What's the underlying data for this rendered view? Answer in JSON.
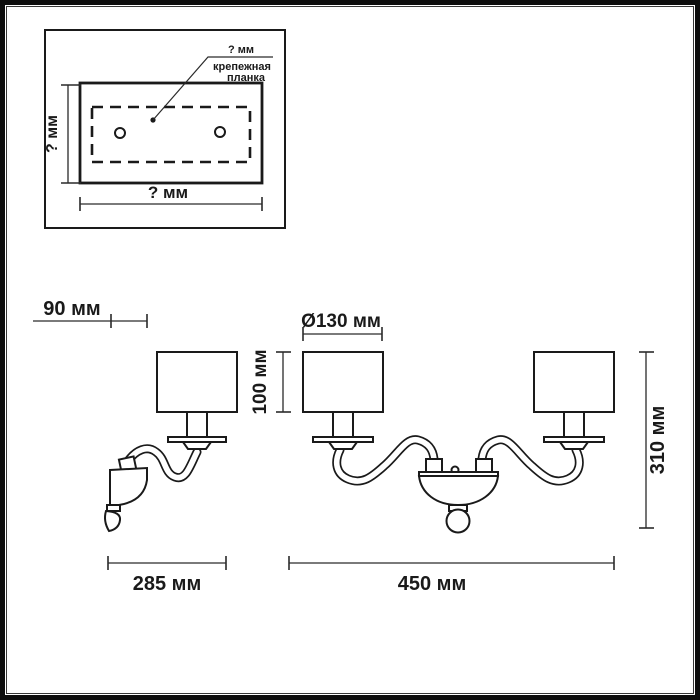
{
  "colors": {
    "line": "#1a1a1a",
    "background": "#ffffff",
    "frame": "#0d0d0d"
  },
  "inset": {
    "top_dim_label": "? мм",
    "callout_line1": "крепежная",
    "callout_line2": "планка",
    "height_dim_label": "? мм",
    "width_dim_label": "? мм"
  },
  "single_sconce": {
    "depth_dim_label": "90 мм",
    "width_dim_label": "285 мм"
  },
  "double_sconce": {
    "shade_diameter_label": "Ø130 мм",
    "shade_height_label": "100 мм",
    "height_dim_label": "310 мм",
    "width_dim_label": "450 мм"
  }
}
